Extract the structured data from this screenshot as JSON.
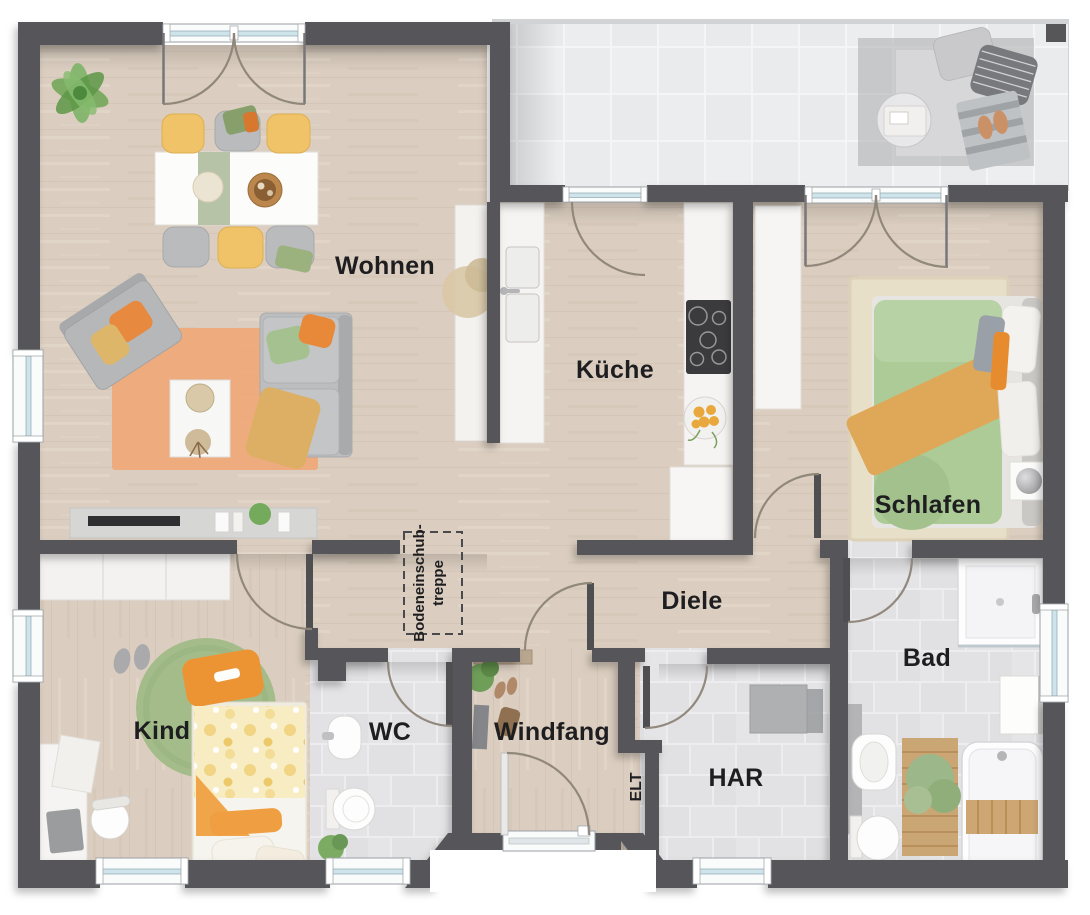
{
  "floorplan": {
    "rooms": {
      "wohnen": {
        "label": "Wohnen"
      },
      "kueche": {
        "label": "Küche"
      },
      "schlafen": {
        "label": "Schlafen"
      },
      "diele": {
        "label": "Diele"
      },
      "bad": {
        "label": "Bad"
      },
      "kind": {
        "label": "Kind"
      },
      "wc": {
        "label": "WC"
      },
      "windfang": {
        "label": "Windfang"
      },
      "har": {
        "label": "HAR"
      },
      "elt": {
        "label": "ELT"
      }
    },
    "annotations": {
      "attic_stair": {
        "line1": "Bodeneinschub-",
        "line2": "treppe"
      }
    },
    "colors": {
      "wall": "#57575a",
      "wood_floor": "#dbcec0",
      "tile_indoor": "#e3e3e5",
      "tile_terrace": "#ebedee",
      "window_glass": "#cfe3ea",
      "accent_orange": "#e8933c",
      "accent_green": "#a9c493",
      "accent_yellow": "#f0c368",
      "label_text": "#1e1e20"
    }
  }
}
